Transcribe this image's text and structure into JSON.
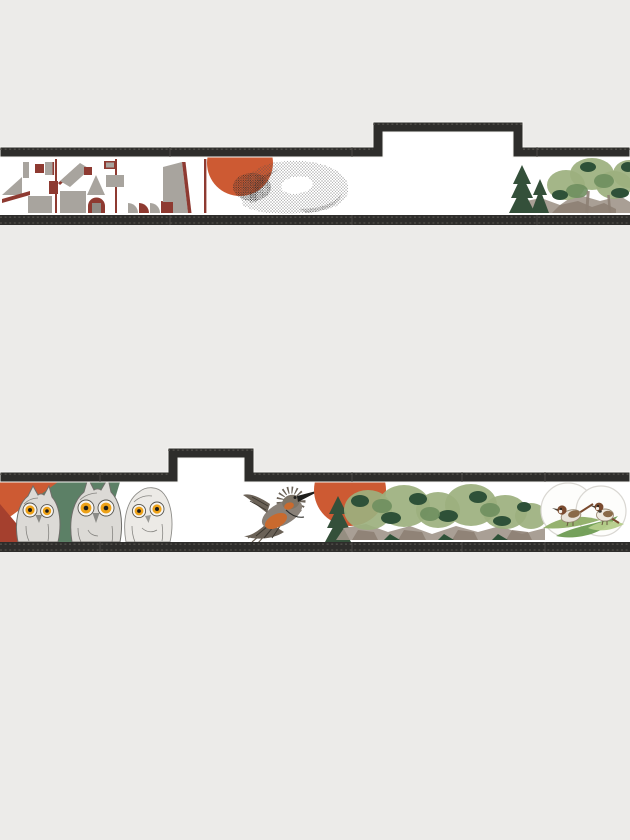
{
  "page": {
    "title": "",
    "background": "#ecebe9",
    "text_items": []
  },
  "palette": {
    "page_bg": "#ecebe9",
    "wall": "#2e2d2b",
    "wall_tick": "#5a5753",
    "panel": "#ffffff",
    "orange": "#cd5a33",
    "orange2": "#c96a2e",
    "brick": "#8e3a31",
    "brick2": "#a5402e",
    "bgray": "#a8a49e",
    "bgray_dark": "#8f8b85",
    "conifer": "#34503a",
    "conifer2": "#2e5138",
    "foliage": "#9cb07e",
    "mgreen": "#6f8f5f",
    "rock": "#a0958a",
    "rock2": "#8d8073",
    "owl": "#dcdad6",
    "owl_pale": "#eceae6",
    "owl_line": "#6f6e6a",
    "eye": "#eda219",
    "pupil": "#1d1d1b",
    "leaf": "#8fae66",
    "leaf2": "#6f9c53",
    "leaf3": "#b5cd8a",
    "bird_brown": "#7a4a2e",
    "bird_tan": "#e8e2d8",
    "kf_gray": "#6b6257",
    "kf_body": "#8a8178",
    "stip": "#4c4c4c",
    "stip_dark": "#2c2b2a",
    "vignette": "#d9d7d2",
    "green2": "#5c8066"
  },
  "strips": [
    {
      "name": "upper-wall-elevation",
      "shape": "long wall section with raised parapet notch near center-right",
      "motifs": [
        {
          "icon": "abstract-village-icon",
          "description": "gray and brick-red geometric buildings"
        },
        {
          "icon": "sun-icon",
          "description": "orange circle clipped by wall cap"
        },
        {
          "icon": "stippled-form-icon",
          "description": "dotted organic shell-like form"
        },
        {
          "icon": "forest-rocks-icon",
          "description": "watercolor conifers, foliage and rocks at right edge"
        }
      ]
    },
    {
      "name": "lower-wall-elevation",
      "shape": "long wall section with raised parapet notch near left",
      "motifs": [
        {
          "icon": "owls-icon",
          "description": "three sketched owls with orange eyes on green and orange triangles"
        },
        {
          "icon": "kingfisher-icon",
          "description": "diving kingfisher with spread wings"
        },
        {
          "icon": "sun-icon",
          "description": "orange circle clipped by wall cap"
        },
        {
          "icon": "tree-row-icon",
          "description": "watercolor tree row with rocks"
        },
        {
          "icon": "sparrows-icon",
          "description": "two sparrows on green leaves inside faint circles"
        }
      ]
    }
  ]
}
